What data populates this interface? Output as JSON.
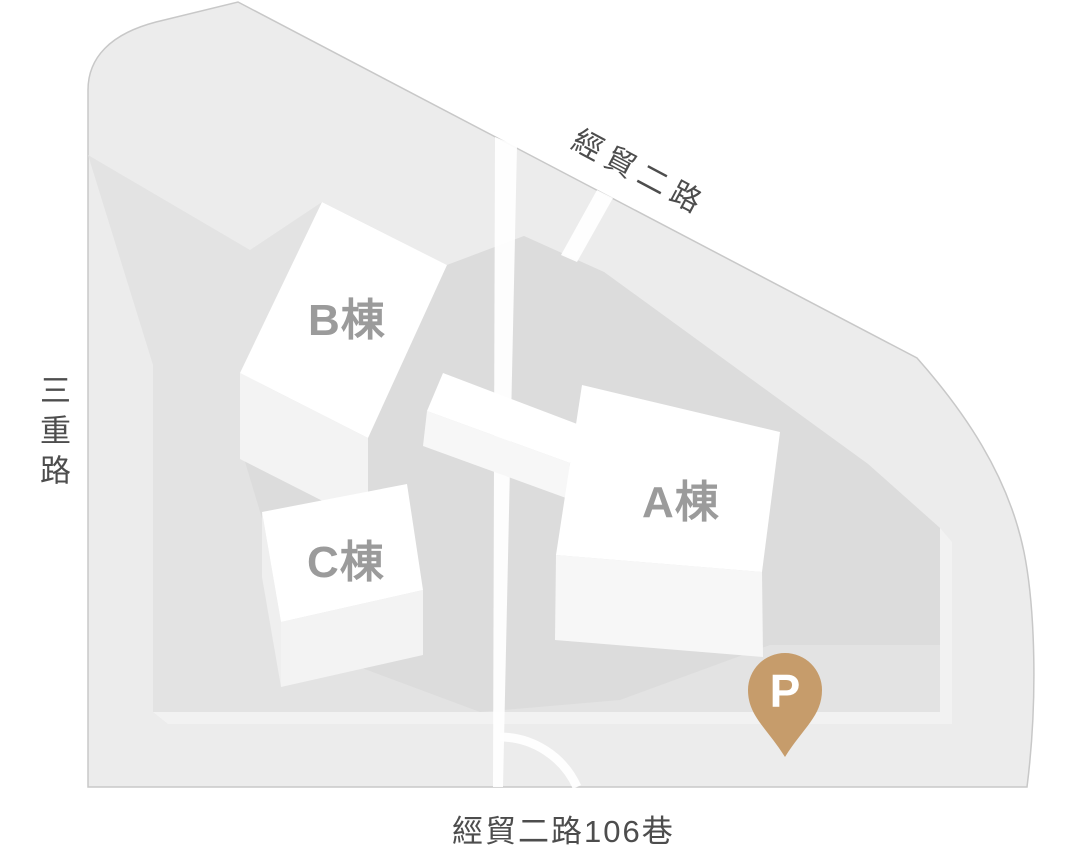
{
  "map": {
    "title": "campus-site-map",
    "streets": {
      "top": "經貿二路",
      "left": "三重路",
      "bottom": "經貿二路106巷"
    },
    "buildings": {
      "a": {
        "label": "A棟"
      },
      "b": {
        "label": "B棟"
      },
      "c": {
        "label": "C棟"
      }
    },
    "parking_marker": {
      "label": "P"
    },
    "colors": {
      "site": "#ECECEC",
      "site_outline": "#C8C8C8",
      "platform": "#E3E3E3",
      "platform_edge": "#F2F2F2",
      "shadow": "#DCDCDC",
      "road": "#FFFFFF",
      "building_roof": "#FFFFFF",
      "building_side": "#F3F3F3",
      "building_side_light": "#F7F7F7",
      "pin": "#C69C6B",
      "street_label": "#4D4D4D",
      "building_label": "#9B9B9B"
    }
  }
}
